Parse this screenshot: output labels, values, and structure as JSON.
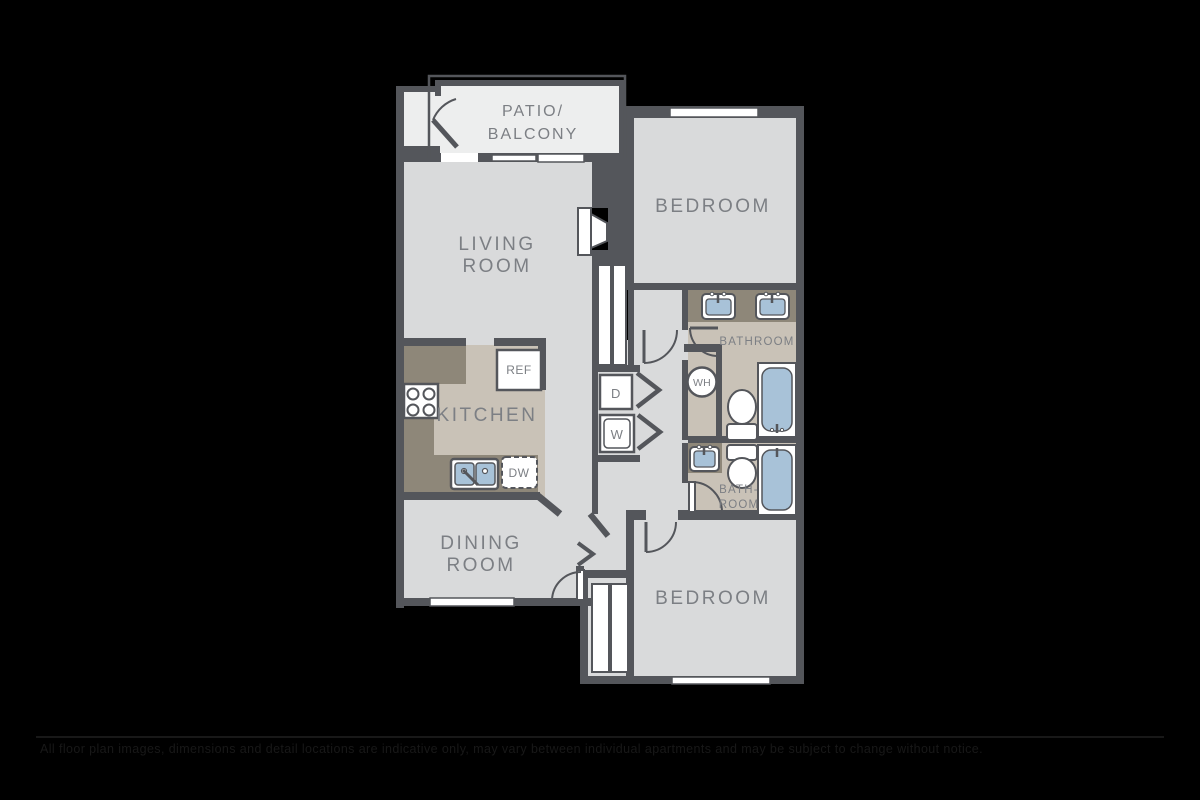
{
  "colors": {
    "background": "#000000",
    "wall": "#54565B",
    "room_floor": "#D9DADB",
    "tile_floor": "#C9C2B7",
    "patio_floor": "#EDEEEE",
    "counter": "#8E8779",
    "fixture_blue": "#A8C2D8",
    "fixture_white": "#FFFFFF",
    "label": "#7C7F84"
  },
  "rooms": {
    "patio": {
      "line1": "PATIO/",
      "line2": "BALCONY"
    },
    "living": {
      "line1": "LIVING",
      "line2": "ROOM"
    },
    "bedroom_top": {
      "label": "BEDROOM"
    },
    "bathroom_top": {
      "label": "BATHROOM"
    },
    "kitchen": {
      "label": "KITCHEN"
    },
    "dining": {
      "line1": "DINING",
      "line2": "ROOM"
    },
    "bathroom_bottom": {
      "line1": "BATH-",
      "line2": "ROOM"
    },
    "bedroom_bottom": {
      "label": "BEDROOM"
    }
  },
  "appliances": {
    "refrigerator": "REF",
    "dishwasher": "DW",
    "dryer": "D",
    "washer": "W",
    "water_heater": "WH"
  },
  "disclaimer": {
    "text": "All floor plan images, dimensions and detail locations are indicative only, may vary between individual apartments and may be subject to change without notice."
  }
}
